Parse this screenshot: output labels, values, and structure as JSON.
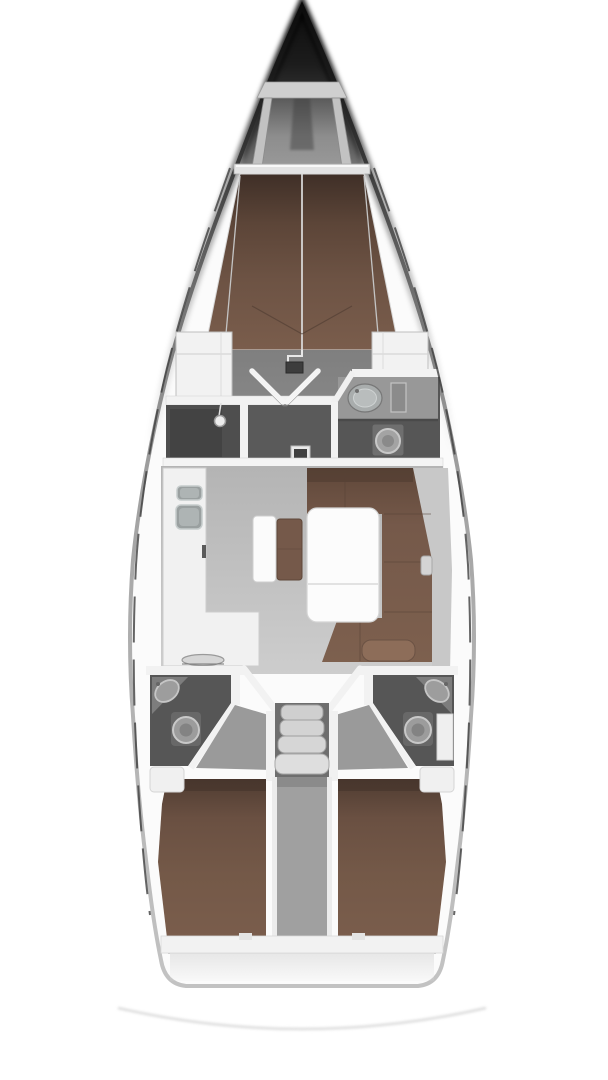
{
  "diagram": {
    "type": "floorplan",
    "subject": "sailing-yacht-interior-layout-top-view",
    "orientation": "bow-up",
    "cabins": 3,
    "heads": 3,
    "regions": [
      {
        "name": "bow-anchor-locker"
      },
      {
        "name": "forepeak-frame"
      },
      {
        "name": "forward-cabin-v-berth"
      },
      {
        "name": "mast-step"
      },
      {
        "name": "port-wardrobe"
      },
      {
        "name": "starboard-wardrobe"
      },
      {
        "name": "forward-cabin-doors"
      },
      {
        "name": "shower-room"
      },
      {
        "name": "forward-head",
        "fixtures": [
          "sink",
          "toilet"
        ]
      },
      {
        "name": "salon-floor"
      },
      {
        "name": "galley",
        "fixtures": [
          "sink-small",
          "sink-large",
          "oven-handle",
          "chart-oval"
        ]
      },
      {
        "name": "u-settee"
      },
      {
        "name": "salon-table"
      },
      {
        "name": "center-seat"
      },
      {
        "name": "port-aft-head",
        "fixtures": [
          "sink",
          "toilet"
        ]
      },
      {
        "name": "starboard-aft-head",
        "fixtures": [
          "sink",
          "toilet"
        ]
      },
      {
        "name": "companionway-steps",
        "tread_count": 4
      },
      {
        "name": "engine-box-divider"
      },
      {
        "name": "port-aft-cabin-berth"
      },
      {
        "name": "starboard-aft-cabin-berth"
      },
      {
        "name": "transom"
      },
      {
        "name": "swim-platform-arc"
      },
      {
        "name": "port-lifeline"
      },
      {
        "name": "starboard-lifeline"
      }
    ]
  },
  "colors": {
    "page-bg": "#ffffff",
    "hull-white": "#fbfbfb",
    "bow-dark": "#0b0b0b",
    "wall-white": "#f2f2f2",
    "berth-dark": "#3f2f27",
    "berth-mid": "#6d5344",
    "berth-light": "#7a5d4c",
    "settee-brown": "#75594a",
    "pillow-brown": "#8d6d59",
    "floor-fwd": "#868686",
    "floor-salon": "#bfbfbf",
    "room-dark": "#565656",
    "corridor-dark": "#5a5a5a",
    "fixture-gray": "#9d9d9d",
    "fixture-rim": "#c8c8c8",
    "sink-steel": "#9aa0a0",
    "counter-white": "#f1f1f1",
    "table-white": "#fcfcfc",
    "steps-gray": "#d6d6d6",
    "divider-gray": "#a0a0a0",
    "rail-dark": "#3e3e3e",
    "arc-gray": "#dcdcdc"
  }
}
